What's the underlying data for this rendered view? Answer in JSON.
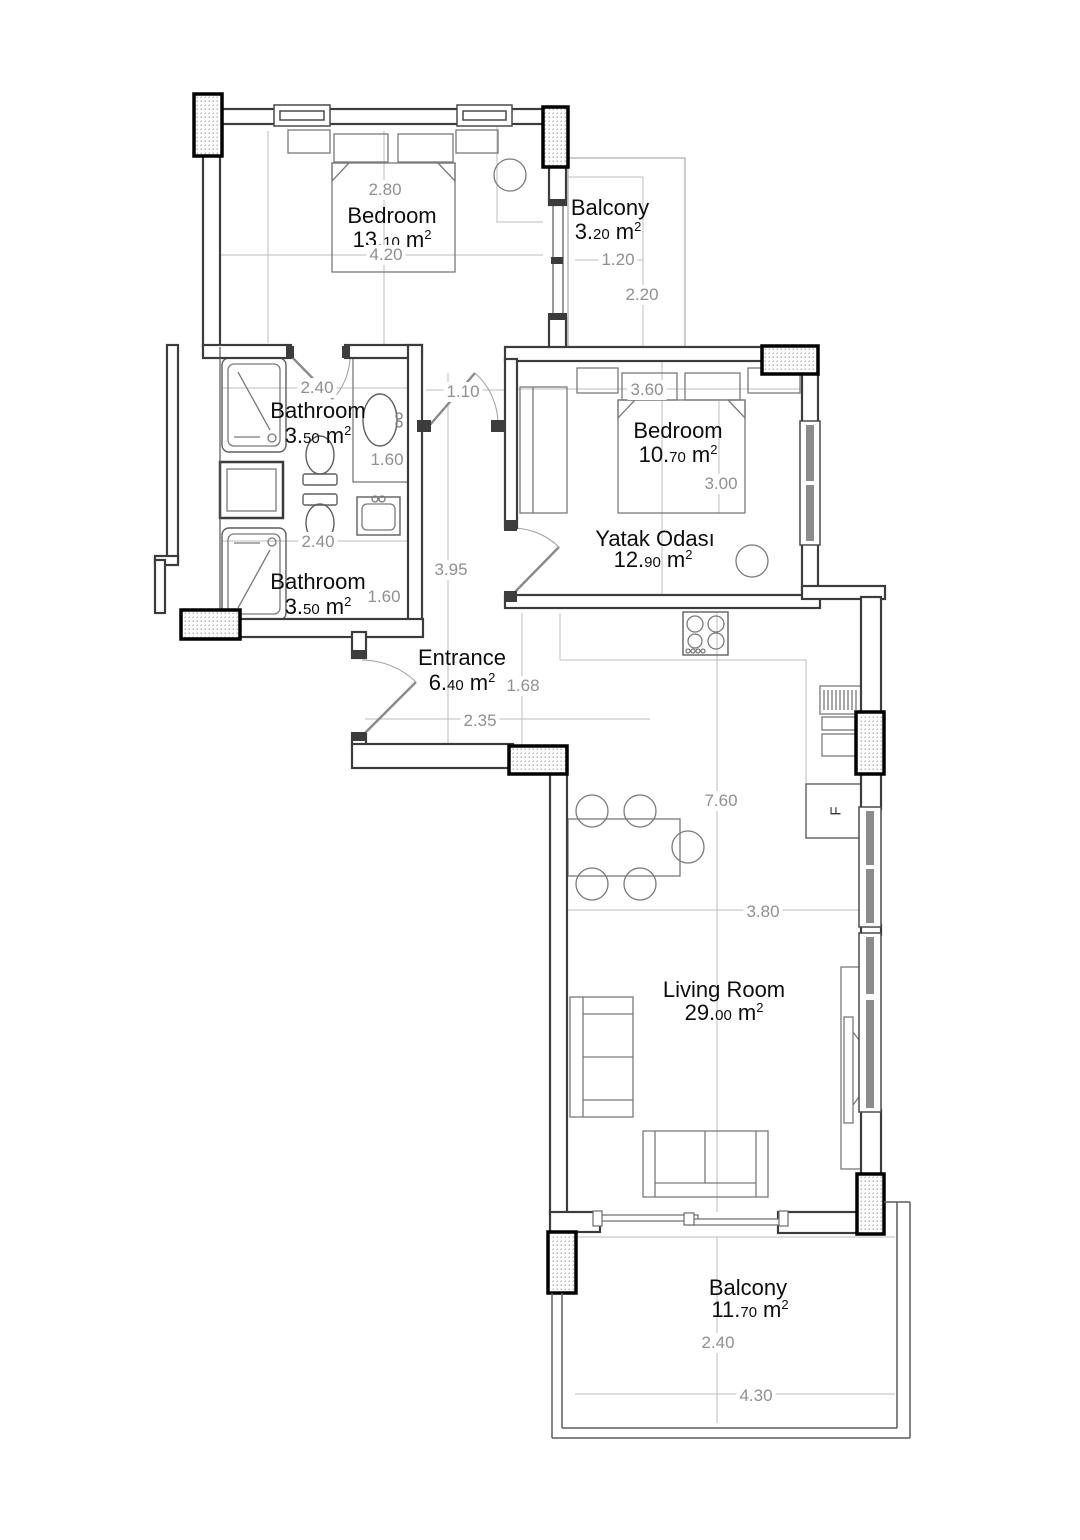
{
  "units": {
    "m": "m",
    "exp": "2"
  },
  "fridge_label": "F",
  "rooms": [
    {
      "name": "Bedroom",
      "area_main": "13.",
      "area_dec": "10"
    },
    {
      "name": "Balcony",
      "area_main": "3.",
      "area_dec": "20"
    },
    {
      "name": "Bathroom",
      "area_main": "3.",
      "area_dec": "50"
    },
    {
      "name": "Bedroom",
      "area_main": "10.",
      "area_dec": "70"
    },
    {
      "name": "Yatak Odası",
      "area_main": "12.",
      "area_dec": "90"
    },
    {
      "name": "Bathroom",
      "area_main": "3.",
      "area_dec": "50"
    },
    {
      "name": "Entrance",
      "area_main": "6.",
      "area_dec": "40"
    },
    {
      "name": "Living Room",
      "area_main": "29.",
      "area_dec": "00"
    },
    {
      "name": "Balcony",
      "area_main": "11.",
      "area_dec": "70"
    }
  ],
  "dimensions": [
    {
      "value": "2.80"
    },
    {
      "value": "4.20"
    },
    {
      "value": "1.20"
    },
    {
      "value": "2.20"
    },
    {
      "value": "2.40"
    },
    {
      "value": "1.60"
    },
    {
      "value": "1.10"
    },
    {
      "value": "3.60"
    },
    {
      "value": "3.00"
    },
    {
      "value": "2.40"
    },
    {
      "value": "1.60"
    },
    {
      "value": "3.95"
    },
    {
      "value": "1.68"
    },
    {
      "value": "2.35"
    },
    {
      "value": "7.60"
    },
    {
      "value": "3.80"
    },
    {
      "value": "2.40"
    },
    {
      "value": "4.30"
    }
  ]
}
